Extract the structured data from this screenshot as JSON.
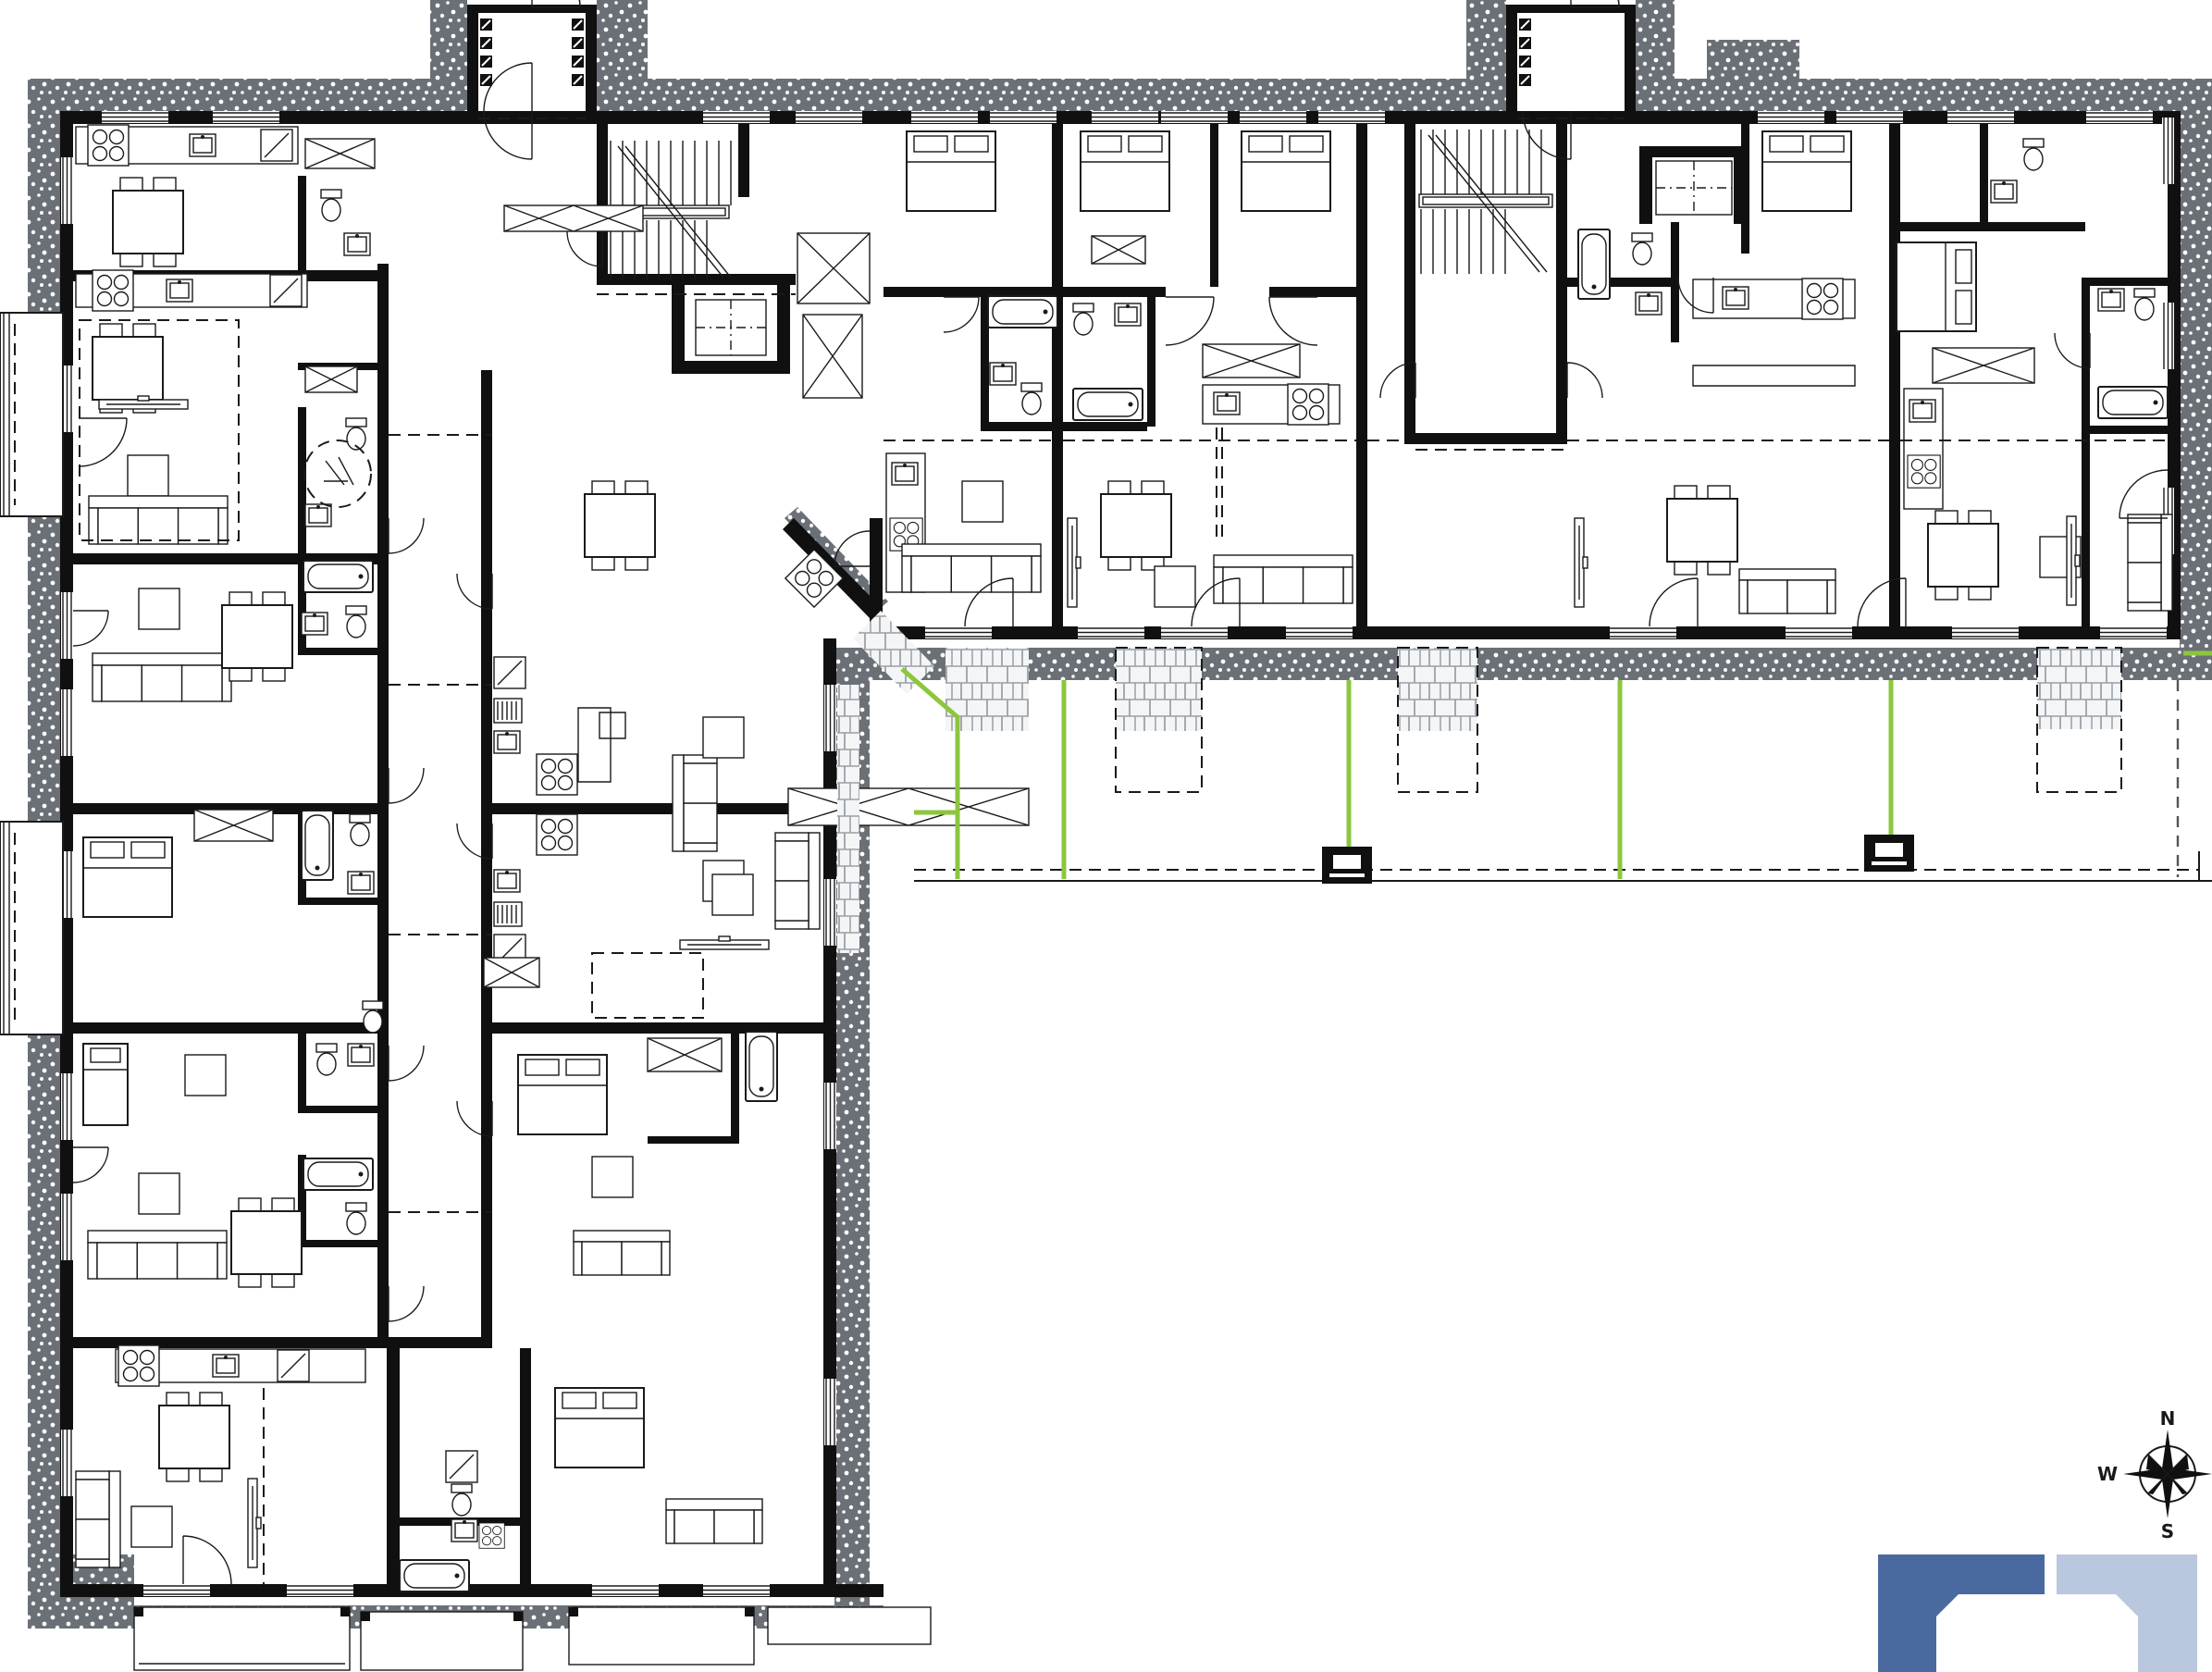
{
  "compass": {
    "north": "N",
    "east": "E",
    "south": "S",
    "west": "W"
  },
  "theme": {
    "paper": "#ffffff",
    "ink": "#1a1a1a",
    "wall": "#101010",
    "hatch": "#6b7077",
    "hatchDot": "#ffffff",
    "brickLine": "#9aa0a6",
    "green": "#8cc63e",
    "dashGray": "#555555",
    "logoDark": "#4a6a9f",
    "logoLight": "#b9c8de"
  },
  "icons": {
    "compass_rose": "eight-point-star-compass",
    "logo": "two-interlocking-corner-brackets"
  }
}
